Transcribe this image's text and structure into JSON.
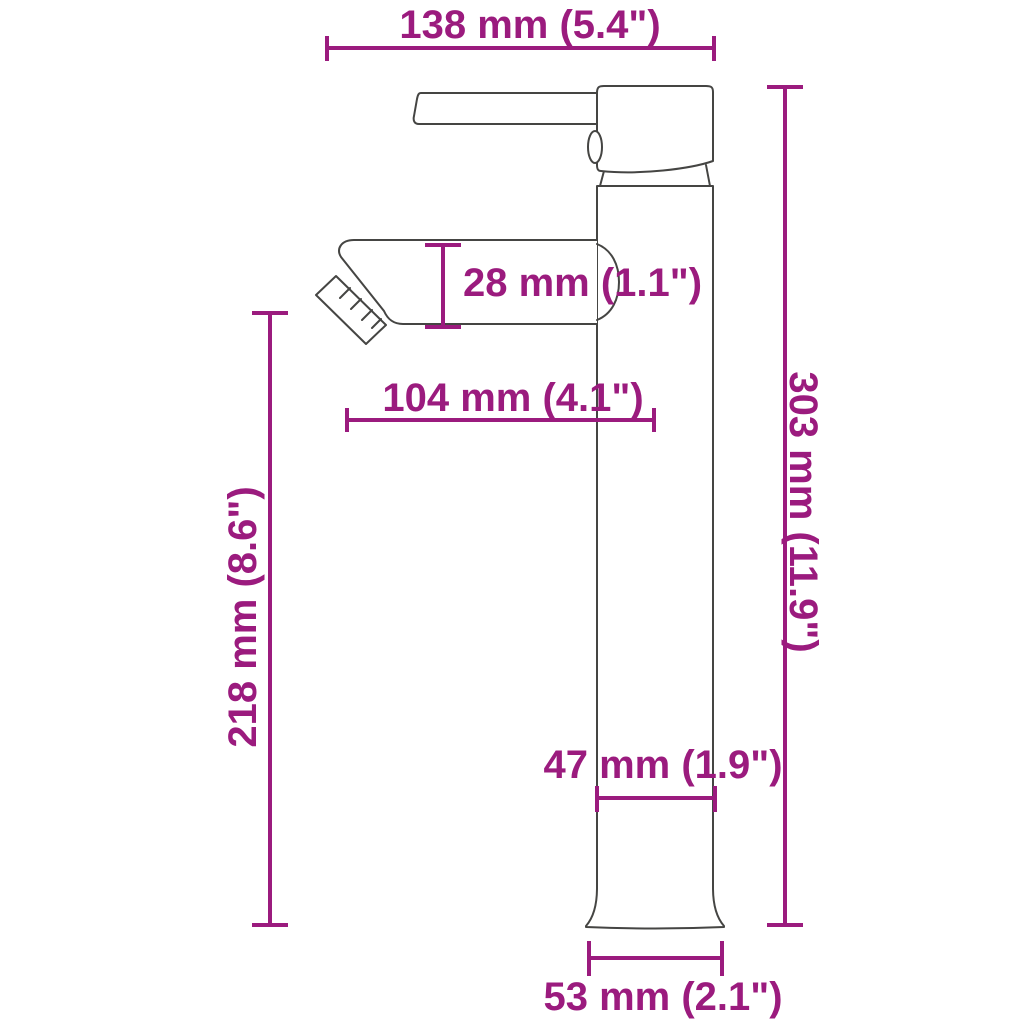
{
  "colors": {
    "accent": "#9B1B7E",
    "outline": "#454543",
    "background": "#FFFFFF"
  },
  "dimensions": {
    "top_width": "138 mm (5.4\")",
    "spout_height": "28 mm (1.1\")",
    "spout_reach": "104 mm (4.1\")",
    "total_height": "303 mm (11.9\")",
    "outlet_height": "218 mm (8.6\")",
    "body_width": "47 mm (1.9\")",
    "base_width": "53 mm (2.1\")"
  }
}
